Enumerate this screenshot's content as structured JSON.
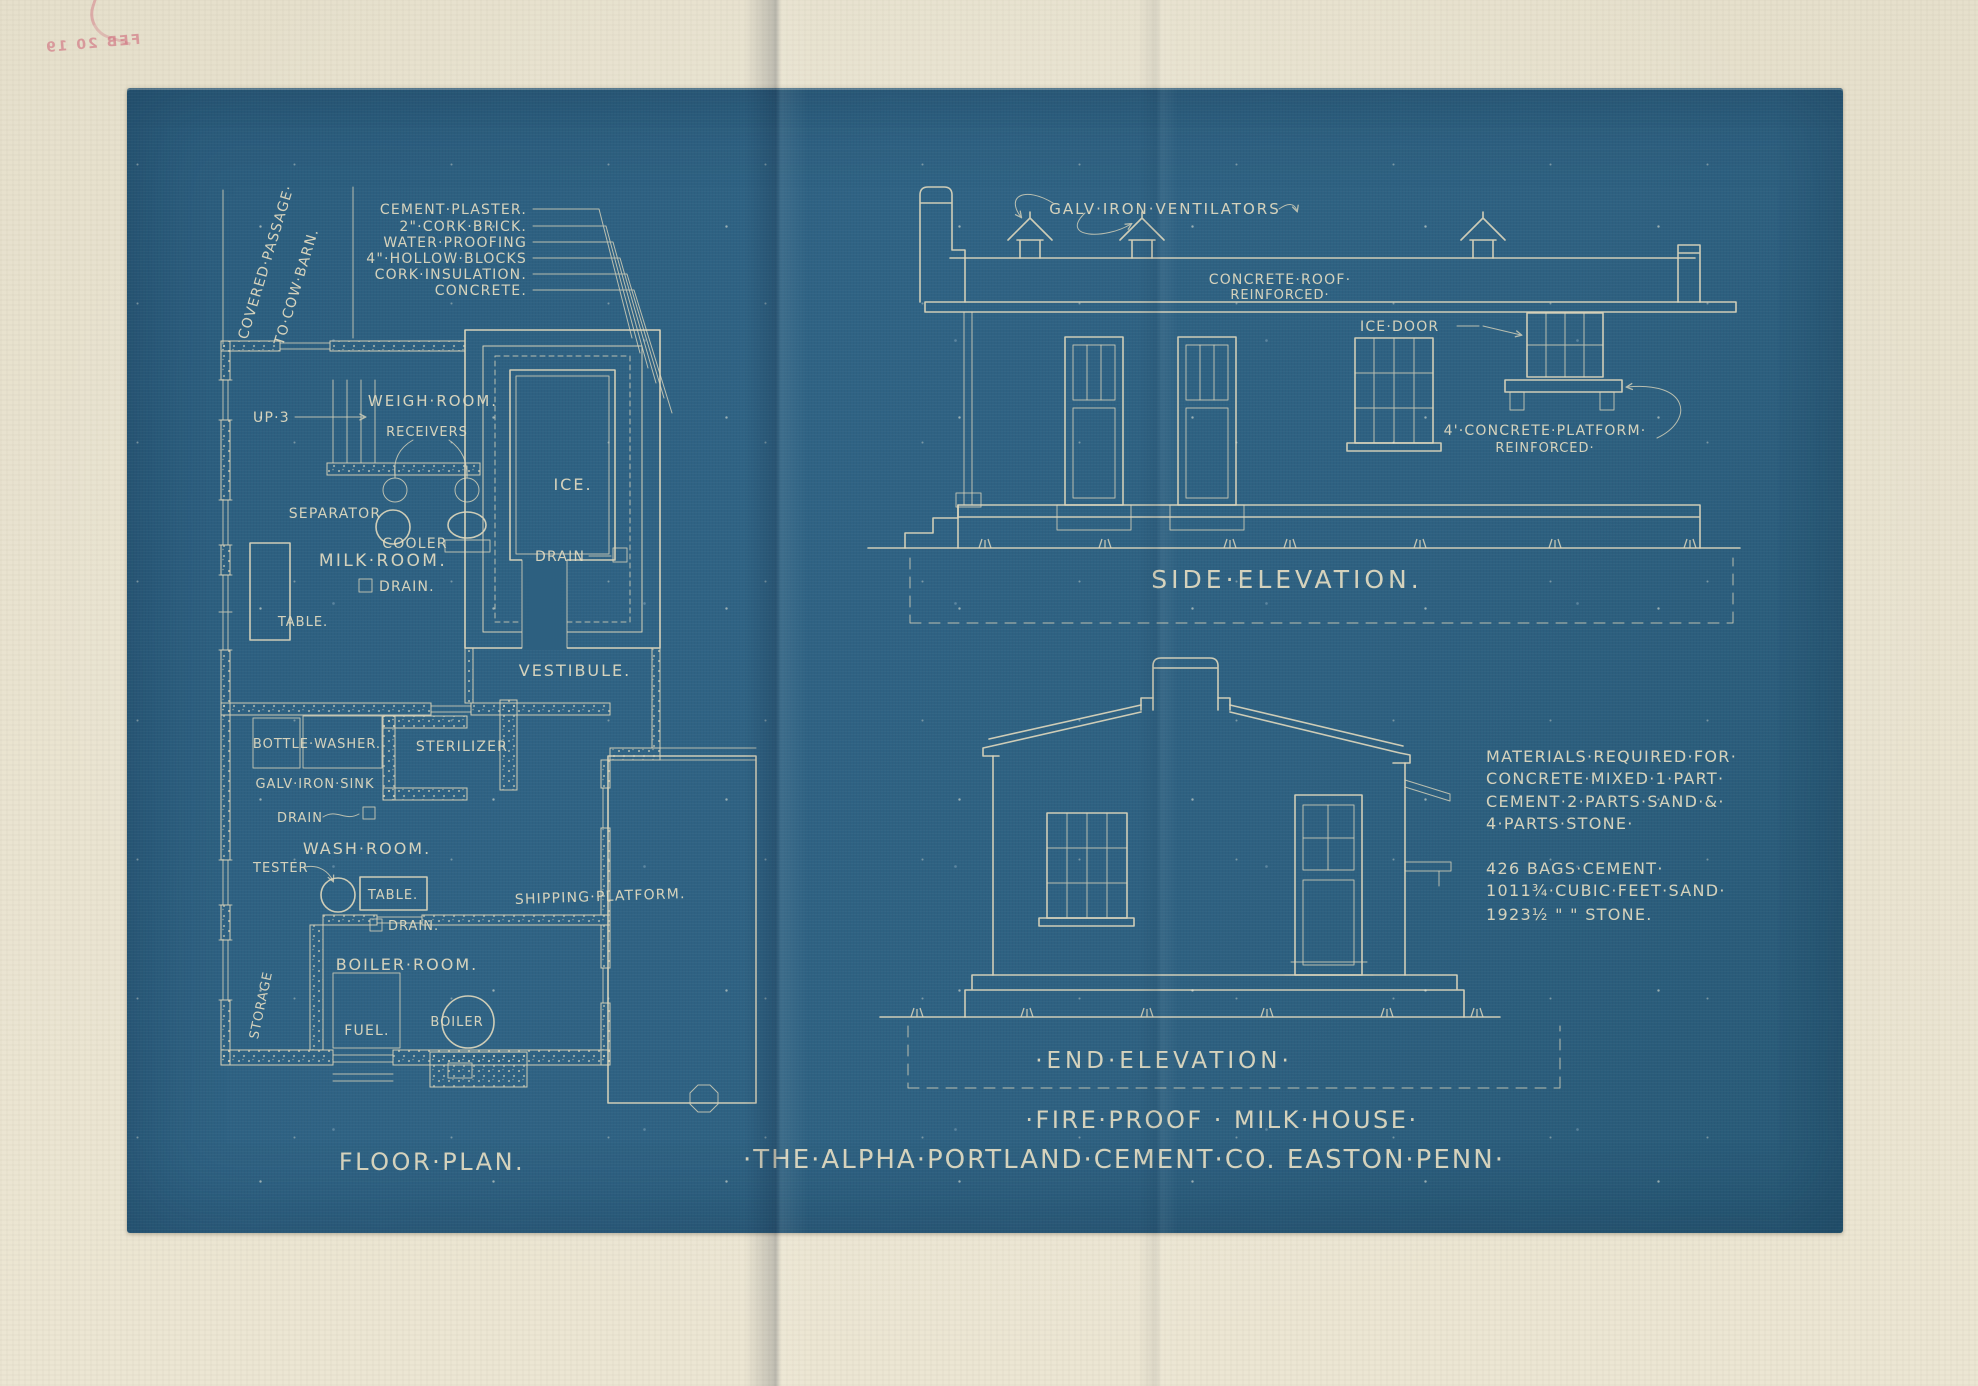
{
  "colors": {
    "paper": "#e8e2d0",
    "blueprint": "#2d6080",
    "ink": "#dcd6bc",
    "stamp_pink": "#ce6074"
  },
  "stamp": {
    "date": "FEB 20 19"
  },
  "floor_plan": {
    "title": "Floor·Plan.",
    "passage_line1": "Covered·Passage·",
    "passage_line2": "to·Cow·Barn.",
    "wall_layers": [
      "Cement·Plaster.",
      "2\"·Cork·Brick.",
      "Water·Proofing",
      "4\"·Hollow·Blocks",
      "Cork·Insulation.",
      "Concrete."
    ],
    "labels": {
      "up": "Up·3",
      "weigh_room": "Weigh·Room.",
      "receivers": "Receivers",
      "separator": "Separator",
      "cooler": "Cooler",
      "milk_room": "Milk·Room.",
      "drain_milk": "Drain.",
      "table_milk": "Table.",
      "ice": "Ice.",
      "drain_ice": "Drain",
      "vestibule": "Vestibule.",
      "bottle_washer": "Bottle·Washer.",
      "sterilizer": "Sterilizer",
      "sink": "Galv·Iron·Sink",
      "drain_sink": "Drain",
      "wash_room": "Wash·Room.",
      "tester": "Tester",
      "table_wash": "Table.",
      "drain_wash": "Drain.",
      "boiler_room": "Boiler·Room.",
      "storage": "Storage",
      "fuel": "Fuel.",
      "boiler": "Boiler",
      "shipping_platform": "Shipping·Platform."
    }
  },
  "side_elevation": {
    "title": "Side·Elevation.",
    "labels": {
      "ventilators": "Galv·Iron·Ventilators",
      "roof1": "Concrete·Roof·",
      "roof2": "Reinforced·",
      "ice_door": "Ice·Door",
      "platform1": "4'·Concrete·Platform·",
      "platform2": "Reinforced·"
    }
  },
  "end_elevation": {
    "title": "·End·Elevation·"
  },
  "materials": {
    "lines": [
      "Materials·Required·For·",
      "Concrete·Mixed·1·Part·",
      "Cement·2·Parts·Sand·&·",
      "4·Parts·Stone·",
      "426 Bags·Cement·",
      "1011¾·Cubic·Feet·Sand·",
      "1923½  \"  \"  Stone."
    ]
  },
  "title_block": {
    "line1": "·Fire·Proof · Milk·House·",
    "line2": "·The·Alpha·Portland·Cement·Co. Easton·Penn·"
  }
}
